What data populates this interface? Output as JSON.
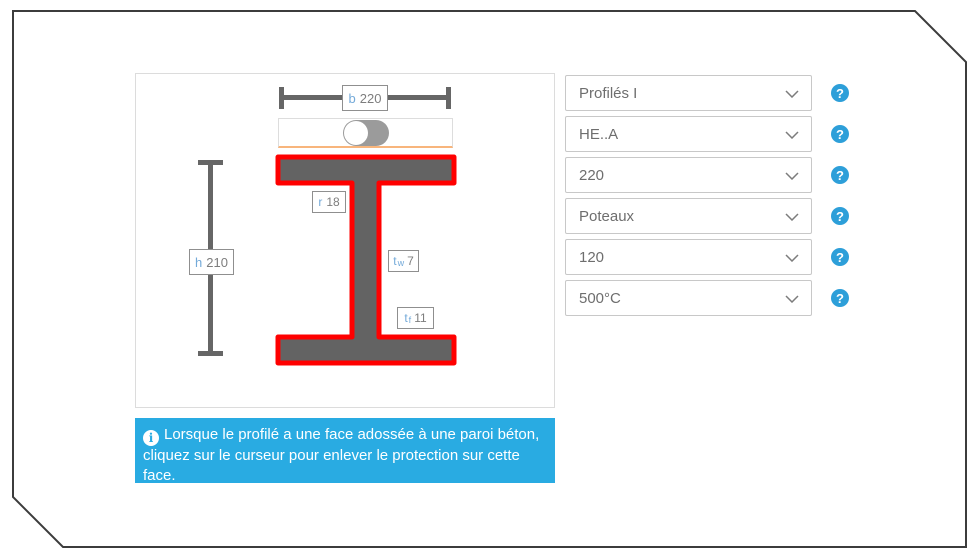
{
  "colors": {
    "frame-border": "#3c3c3c",
    "panel-border": "#dcdcdc",
    "dim": "#666666",
    "beam-fill": "#636363",
    "beam-border": "#ff0000",
    "label-border": "#8f8f8f",
    "label-letter": "#74aad9",
    "label-value": "#7d7d7d",
    "toggle-border": "#dddddd",
    "toggle-underline": "#f8b57c",
    "toggle-track": "#9b9b9b",
    "toggle-knob": "#ffffff",
    "dropdown-border": "#c8c8c8",
    "dropdown-text": "#6e6e6e",
    "chevron": "#7c7c7c",
    "help-blue": "#2d9fd9",
    "info-bg": "#29abe2",
    "info-text": "#ffffff"
  },
  "diagram": {
    "b": {
      "letter": "b",
      "value": "220"
    },
    "h": {
      "letter": "h",
      "value": "210"
    },
    "r": {
      "letter": "r",
      "value": "18"
    },
    "tw": {
      "letter": "t",
      "sub": "w",
      "value": "7"
    },
    "tf": {
      "letter": "t",
      "sub": "f",
      "value": "11"
    }
  },
  "toggle": {
    "state": "on"
  },
  "dropdowns": [
    {
      "value": "Profilés I"
    },
    {
      "value": "HE..A"
    },
    {
      "value": "220"
    },
    {
      "value": "Poteaux"
    },
    {
      "value": "120"
    },
    {
      "value": "500°C"
    }
  ],
  "help": {
    "glyph": "?"
  },
  "info": {
    "icon_glyph": "i",
    "text": "Lorsque le profilé a une face adossée à une paroi béton, cliquez sur le curseur pour enlever le protection sur cette face."
  }
}
